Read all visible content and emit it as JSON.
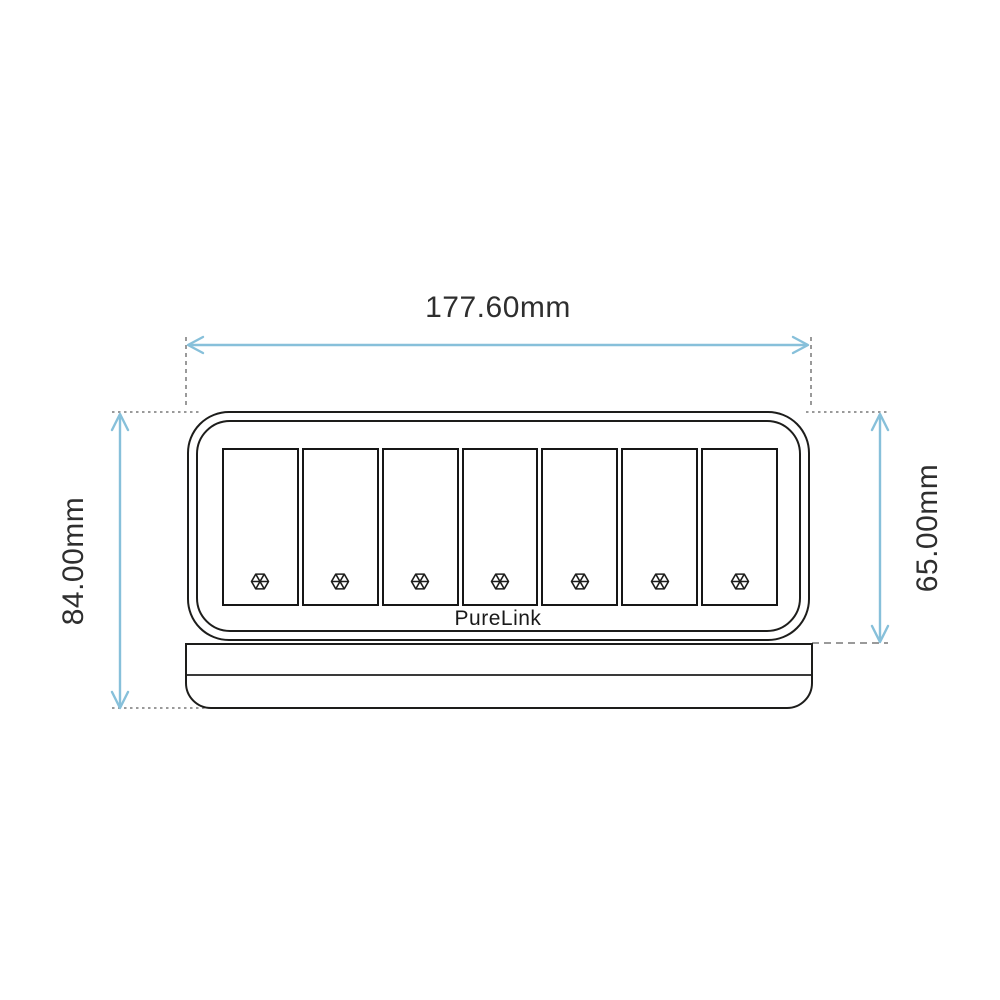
{
  "diagram": {
    "type": "technical-dimension-drawing",
    "product": {
      "brand": "PureLink",
      "description": "7-slot modular faceplate front view",
      "slot_count": 7,
      "slot_icon": "hex-screw-icon"
    },
    "dimension_labels": {
      "width": "177.60mm",
      "overall_height": "84.00mm",
      "plate_height": "65.00mm"
    },
    "colors": {
      "dimension_arrow": "#87c0da",
      "extension_line": "#9a9a9a",
      "outline": "#1d1d1b",
      "label_text": "#2e2e2e",
      "background": "#ffffff"
    }
  }
}
